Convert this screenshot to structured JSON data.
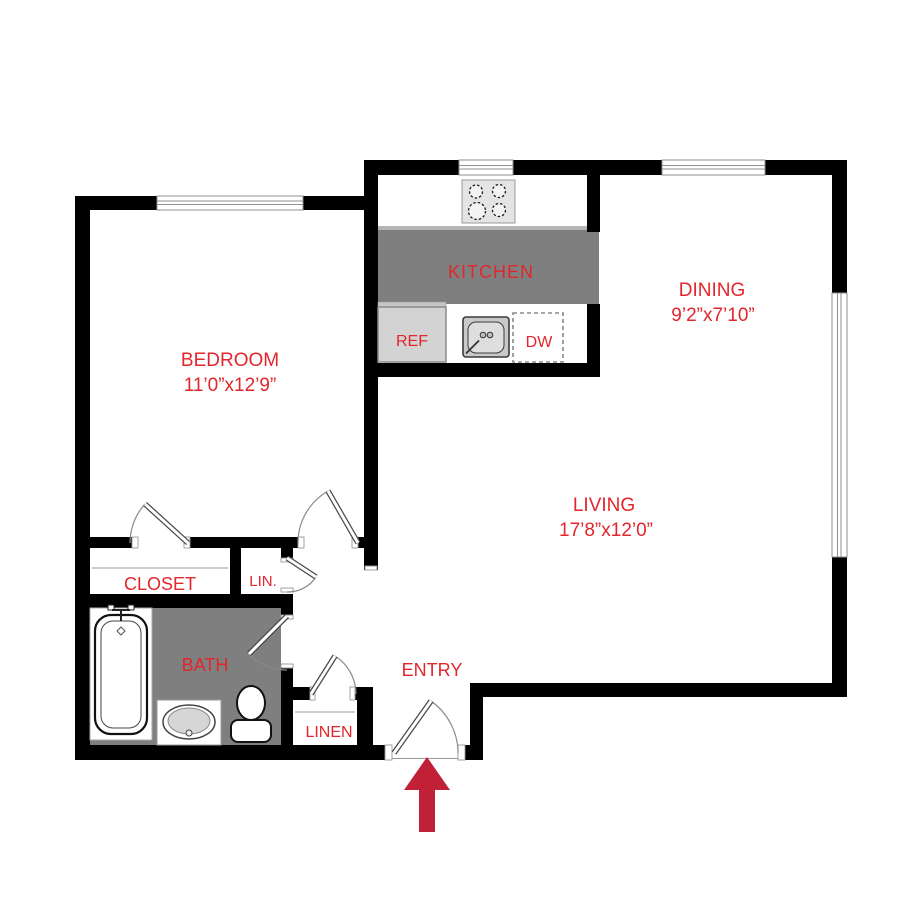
{
  "labels": {
    "bedroom": {
      "name": "BEDROOM",
      "dims": "11’0”x12’9”"
    },
    "kitchen": {
      "name": "KITCHEN"
    },
    "dining": {
      "name": "DINING",
      "dims": "9’2”x7’10”"
    },
    "living": {
      "name": "LIVING",
      "dims": "17’8”x12’0”"
    },
    "closet": {
      "name": "CLOSET"
    },
    "lin": {
      "name": "LIN."
    },
    "bath": {
      "name": "BATH"
    },
    "linen": {
      "name": "LINEN"
    },
    "entry": {
      "name": "ENTRY"
    },
    "ref": {
      "name": "REF"
    },
    "dw": {
      "name": "DW"
    }
  },
  "colors": {
    "wall": "#000000",
    "label_red": "#e2262b",
    "arrow_red": "#c02136",
    "floor_gray": "#7f7f7f",
    "counter_edge_gray": "#b5b5b5",
    "appliance_gray": "#d3d3d3",
    "stove_gray": "#e4e4e4"
  },
  "icons": {
    "entry_arrow": "up-arrow",
    "fixtures": [
      "stove-icon",
      "kitchen-sink-icon",
      "dishwasher-icon",
      "refrigerator-icon",
      "bathtub-icon",
      "vanity-sink-icon",
      "toilet-icon"
    ],
    "openings": [
      "bedroom-window",
      "stove-window",
      "dining-window",
      "living-window",
      "closet-door",
      "bedroom-door",
      "lin-door",
      "bath-door",
      "linen-door",
      "entry-door"
    ]
  }
}
